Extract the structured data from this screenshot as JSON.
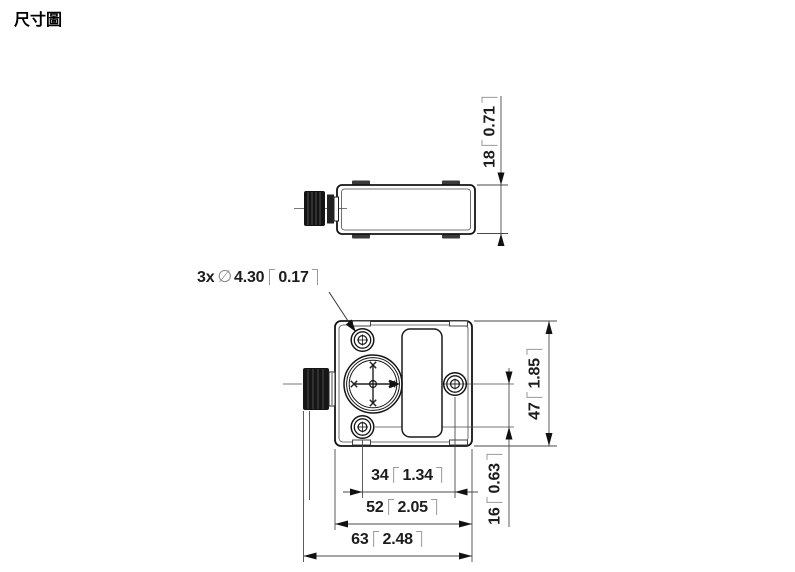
{
  "page": {
    "title": "尺寸圖"
  },
  "drawing": {
    "hole_callout": {
      "prefix": "3x",
      "diameter_symbol": "∅",
      "value_mm": "4.30",
      "value_in": "0.17"
    },
    "dimensions": {
      "housing_depth": {
        "mm": "18",
        "in": "0.71"
      },
      "housing_height": {
        "mm": "47",
        "in": "1.85"
      },
      "hole_offset": {
        "mm": "16",
        "in": "0.63"
      },
      "hole_spacing": {
        "mm": "34",
        "in": "1.34"
      },
      "housing_width": {
        "mm": "52",
        "in": "2.05"
      },
      "total_width": {
        "mm": "63",
        "in": "2.48"
      }
    }
  }
}
